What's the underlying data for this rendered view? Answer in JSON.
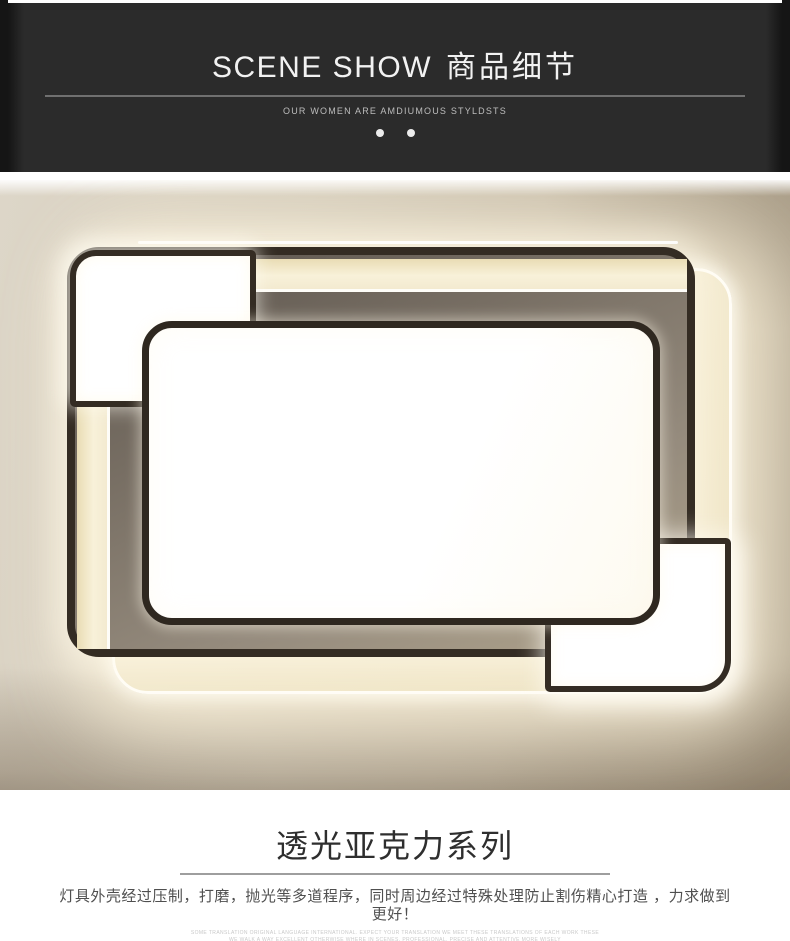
{
  "header": {
    "brand_title_en": "SCENE SHOW",
    "brand_title_zh": "商品细节",
    "tagline": "OUR WOMEN ARE AMDIUMOUS STYLDSTS",
    "dots_count": 2
  },
  "photo": {
    "alt": "rectangular acrylic LED ceiling lamp: two offset dark-trimmed frames, lit white corner panels, warm backlight glow on taupe wall"
  },
  "caption": {
    "series_title": "透光亚克力系列",
    "description": "灯具外壳经过压制，打磨，抛光等多道程序，同时周边经过特殊处理防止割伤精心打造 ，力求做到更好！",
    "fine_print": [
      "SOME TRANSLATION ORIGINAL LANGUAGE INTERNATIONAL. EXPECT YOUR TRANSLATION WE MEET THESE TRANSLATIONS OF EACH WORK THESE",
      "WE WALK A WAY EXCELLENT OTHERWISE WHERE IN SCENES. PROFESSIONAL. PRECISE AND ATTENTIVE MORE WISELY"
    ]
  },
  "colors": {
    "header_bg": "#2b2b2b",
    "header_text": "#f2f2f2",
    "subtitle_text": "#bdbdbd",
    "frame_dark": "#342c23",
    "panel_white": "#ffffff",
    "light_cream": "#f6edd2",
    "backing_gray": "#8d8478",
    "glow": "#fdf4da",
    "title_text": "#2e2e2e",
    "body_text": "#4f4f4f",
    "divider_gray": "#9e9e9e"
  }
}
